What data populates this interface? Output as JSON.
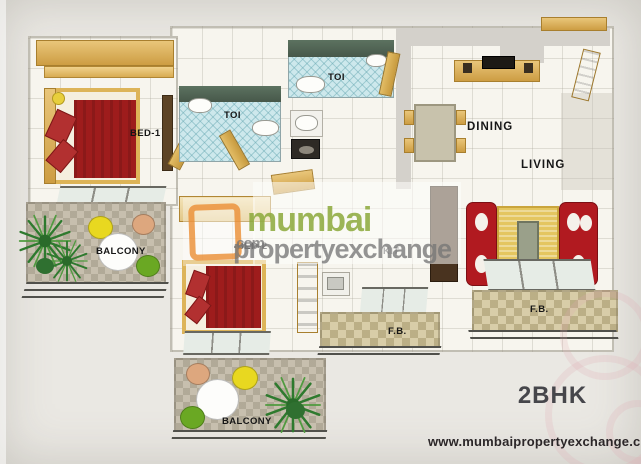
{
  "labels": {
    "bed1": "BED-1",
    "toi1": "TOI",
    "toi2": "TOI",
    "bed2": "BED-2",
    "kitchen": "KIT",
    "dining": "DINING",
    "living": "LIVING",
    "balcony1": "BALCONY",
    "balcony2": "BALCONY",
    "fb1": "F.B.",
    "fb2": "F.B."
  },
  "watermark": {
    "brand": "mumbai",
    "brand2": "propertyexchange",
    "tld": ".com"
  },
  "footer": {
    "plan_type": "2BHK",
    "website": "www.mumbaipropertyexchange.com"
  },
  "colors": {
    "bed_red": "#9e1c1c",
    "sofa_red": "#b11a20",
    "wood_tan": "#d2a04a",
    "toilet_wall_green": "#50654f",
    "toilet_floor_blue": "#cde8ec",
    "carpet_gold": "#e4c660",
    "balcony_tile": "#c7bfae",
    "fb_tile": "#d8cda8",
    "plant_green": "#2e7a2e",
    "watermark_green": "#8bab3a",
    "watermark_gray": "#767676",
    "background": "#eae8e3"
  }
}
